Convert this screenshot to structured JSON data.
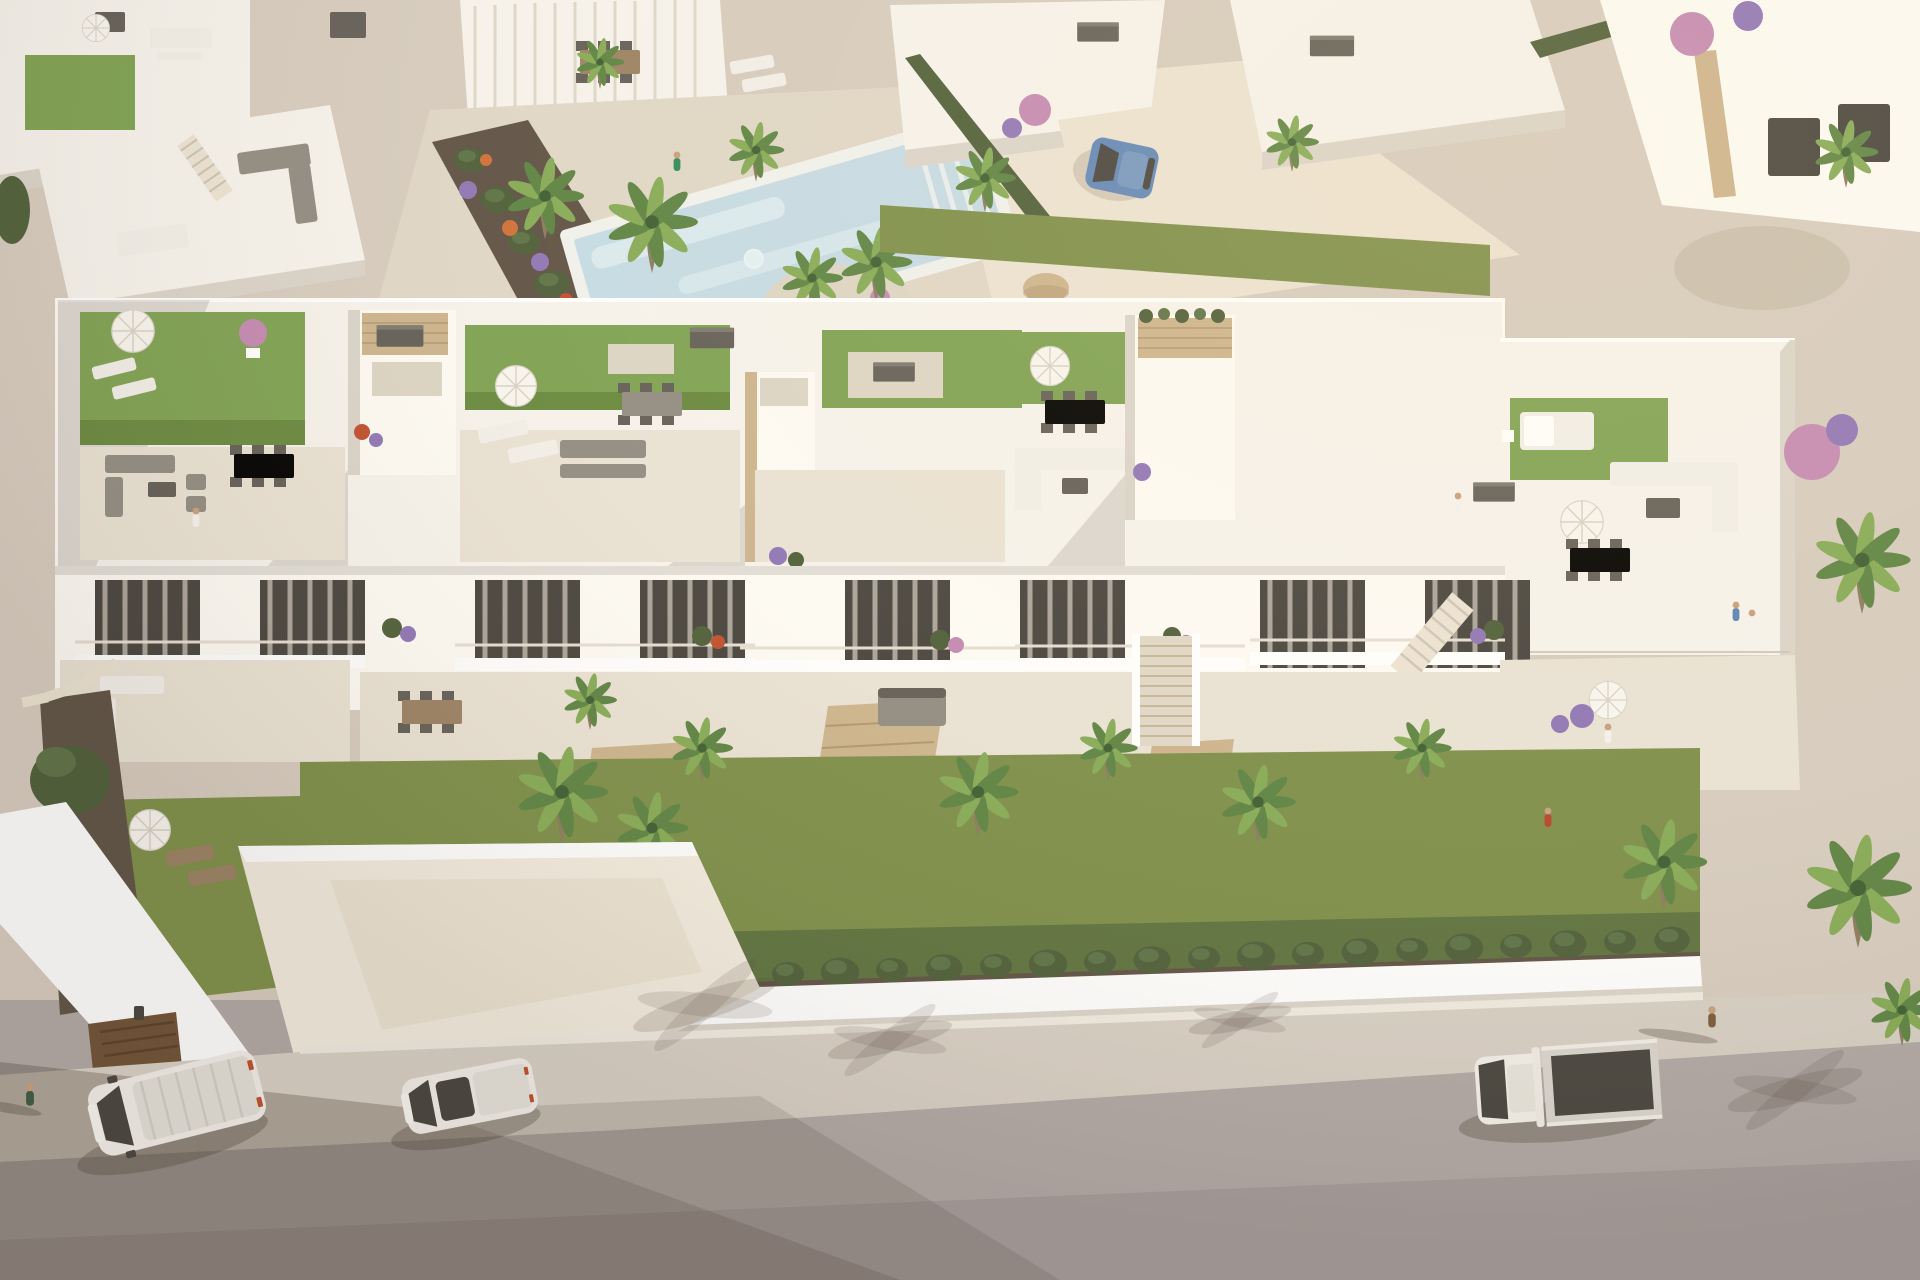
{
  "meta": {
    "title": "Aerial 3D architectural rendering of a modern white Mediterranean residential complex with rooftop terraces, communal pool and street at golden hour"
  },
  "palette": {
    "ground": "#d6ccbf",
    "path": "#e0d7c8",
    "pathBright": "#ece3d3",
    "poolDeck": "#e9e2d4",
    "roof": "#f6f3ed",
    "wallSun": "#fdfbf5",
    "wallShade": "#dad4ca",
    "wallDeep": "#c6bfb4",
    "turf": "#7ea253",
    "turfDark": "#69893f",
    "grass": "#7d8f4a",
    "grassDark": "#5e7340",
    "hedge": "#4e5f3a",
    "cypress": "#5d7347",
    "palm": "#5d8444",
    "palmLight": "#86ab57",
    "palmDark": "#3e5e33",
    "trunk": "#8b7b60",
    "stone": "#ccb48e",
    "stoneDark": "#b1976f",
    "pebble": "#dcd5c6",
    "gravel": "#c9c0af",
    "soil": "#5f5346",
    "furn": "#918c83",
    "furnDark": "#635f58",
    "furnLight": "#f2efe9",
    "wood": "#9b8264",
    "woodDark": "#77624c",
    "pool": "#c5dce6",
    "poolLight": "#e2f0f4",
    "asphalt": "#b1a9a6",
    "asphaltDark": "#9a928f",
    "sidewalk": "#d8d0c6",
    "curb": "#f0ebe2",
    "glass": "#47443e",
    "doorBrown": "#6f5236",
    "carBlue": "#6288b8",
    "skin": "#c99f7d",
    "white": "#ffffff",
    "shadow": "rgba(70,58,48,0.30)",
    "shadowSoft": "rgba(70,58,48,0.15)",
    "flowerPurple": "#9076b6",
    "flowerPink": "#c489b3",
    "flowerRed": "#bf4f2e",
    "flowerOrange": "#d0703a"
  },
  "scene": {
    "viewpoint": "high aerial view looking down at the front row of townhouses",
    "lighting": {
      "sun_from": "upper right",
      "shadows": "long, cast toward lower left",
      "mood": "warm golden hour"
    },
    "main_building": {
      "type": "row of modern flat-roofed white townhouses",
      "units_visible": 5,
      "rooftop_terraces": {
        "artificial_turf_lawns": 6,
        "white_parasols": 5,
        "dining_sets": 4,
        "lounge_sofas": 4,
        "sun_loungers": 4,
        "daybeds": 2,
        "ac_units": 6,
        "stone_clad_stair_towers": 4,
        "glass_balustrades": true
      },
      "facade": {
        "balconies": 5,
        "curtained_glass_doors": 8,
        "planters": "green shrubs with purple and red flowers",
        "stone_clad_fins": 3,
        "central_access_stair": true
      }
    },
    "amenities": {
      "pool": {
        "shape": "rectangular, set diagonally",
        "water_color": "light blue",
        "steps_at_end": true,
        "planted_island": "palms with pink and purple flowers",
        "swimmers": 1
      },
      "sun_deck": true,
      "flower_beds": "purple, orange and pink blooms along the walkways"
    },
    "landscaping": {
      "palm_trees": 14,
      "banana_plants": 6,
      "cypress_hedge_segments": 26,
      "rooftop_turf": "bright green",
      "ground_lawn": "olive green",
      "bougainvillea": "pink and purple on neighbouring villas"
    },
    "street": {
      "surface": "grey asphalt, no markings",
      "sidewalk": "light speckled concrete behind a low white boundary wall",
      "vehicles": [
        {
          "type": "panel van",
          "color": "white",
          "location": "street left"
        },
        {
          "type": "compact van",
          "color": "white",
          "location": "street left-centre"
        },
        {
          "type": "flatbed pickup",
          "color": "white with dark grey bed",
          "location": "street right"
        },
        {
          "type": "hatchback",
          "color": "blue",
          "location": "upper driveway between villas"
        }
      ],
      "pedestrians_on_street": 2
    },
    "people_total": 11,
    "neighbourhood": {
      "style": "white cubic villas with travertine stone accents and rooftop terraces",
      "garage_door": "brown, lower left courtyard",
      "rooftop_lawns_on_neighbours": true
    }
  }
}
